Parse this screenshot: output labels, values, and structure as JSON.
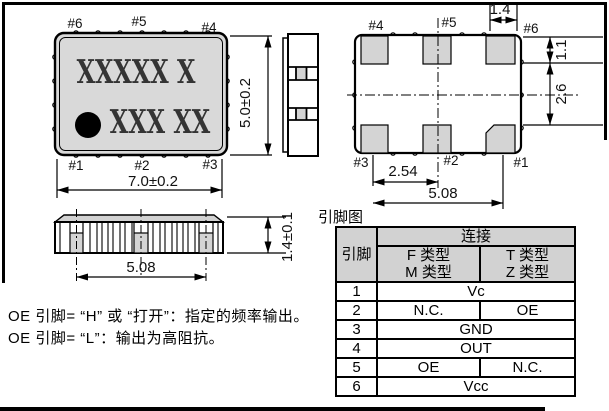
{
  "top_view": {
    "pin_top_left": "#6",
    "pin_top_mid": "#5",
    "pin_top_right": "#4",
    "pin_bot_left": "#1",
    "pin_bot_mid": "#2",
    "pin_bot_right": "#3",
    "marking_line1": "XXXXX X",
    "marking_line2": "XXX XX",
    "dim_width": "7.0±0.2",
    "dim_height": "5.0±0.2"
  },
  "bottom_view": {
    "pin_top_left": "#4",
    "pin_top_mid": "#5",
    "pin_top_right": "#6",
    "pin_bot_left": "#3",
    "pin_bot_mid": "#2",
    "pin_bot_right": "#1",
    "dim_pad_width": "1.4",
    "dim_pad_height": "1.1",
    "dim_row_pitch": "2.6",
    "dim_col_pitch": "2.54",
    "dim_span": "5.08"
  },
  "front_view": {
    "dim_span": "5.08",
    "dim_height": "1.4±0.1"
  },
  "notes": {
    "line1": "OE 引脚= “H” 或 “打开”：指定的频率输出。",
    "line2": "OE 引脚= “L”：输出为高阻抗。"
  },
  "pin_table": {
    "title": "引脚图",
    "header": {
      "pin": "引脚",
      "connection": "连接",
      "col_f_line1": "F 类型",
      "col_f_line2": "M 类型",
      "col_t_line1": "T 类型",
      "col_t_line2": "Z 类型"
    },
    "rows": [
      {
        "pin": "1",
        "value": "Vc"
      },
      {
        "pin": "2",
        "f": "N.C.",
        "t": "OE"
      },
      {
        "pin": "3",
        "value": "GND"
      },
      {
        "pin": "4",
        "value": "OUT"
      },
      {
        "pin": "5",
        "f": "OE",
        "t": "N.C."
      },
      {
        "pin": "6",
        "value": "Vcc"
      }
    ]
  },
  "colors": {
    "line": "#000000",
    "body_gray": "#d9d9d9",
    "pad_gray": "#d4d4d4",
    "header_gray": "#d2d2d2"
  }
}
